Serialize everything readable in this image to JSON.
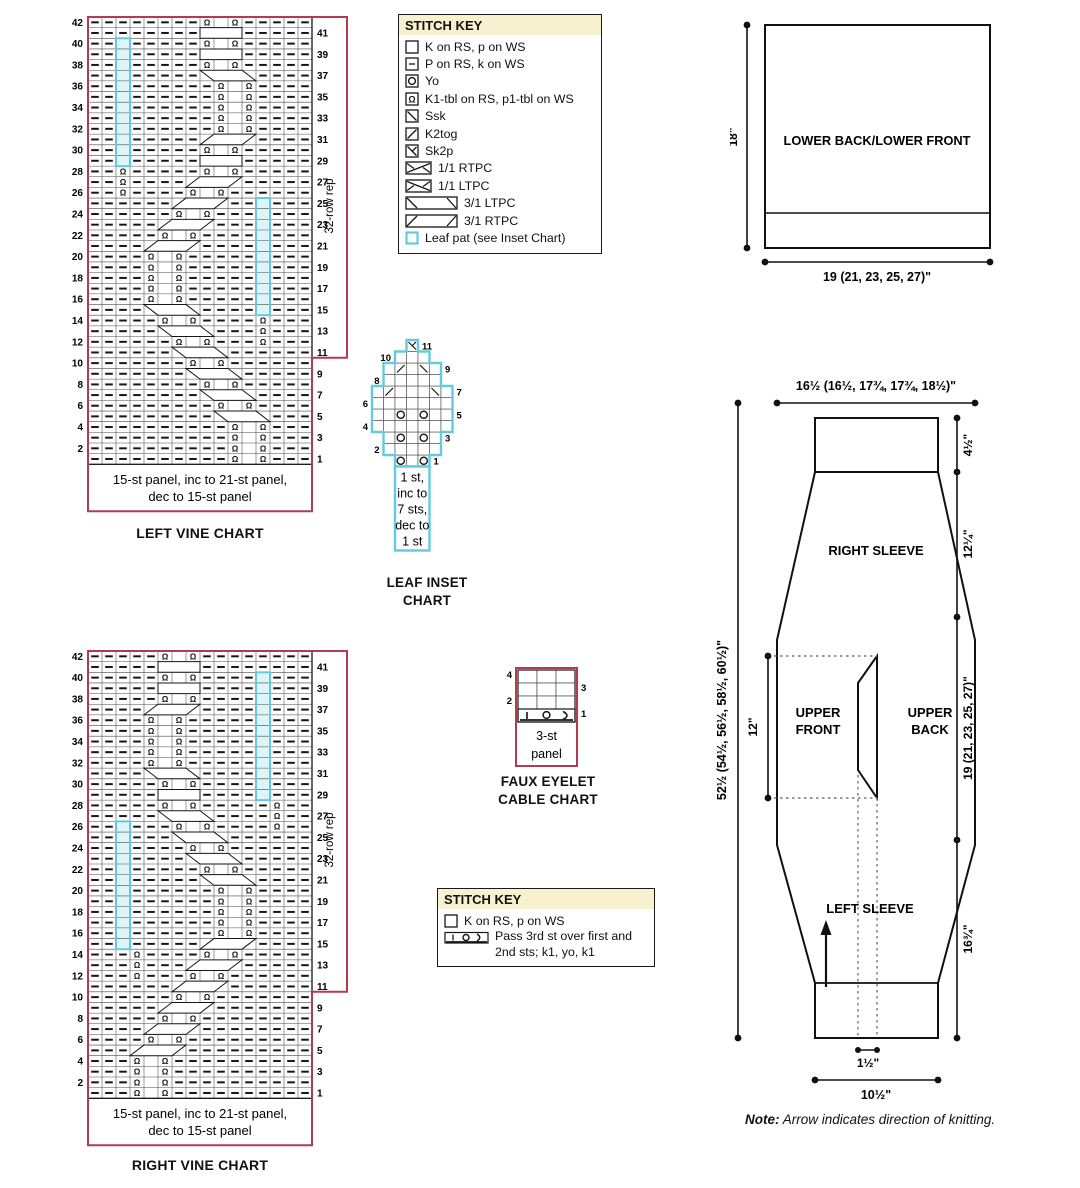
{
  "colors": {
    "red": "#b43a50",
    "cyan": "#63cbdd",
    "cyan_fill": "#def4f9",
    "cream": "#f8f1cf",
    "ink": "#111111"
  },
  "left_vine_chart": {
    "title": "LEFT VINE CHART",
    "caption_line1": "15-st panel, inc to 21-st panel,",
    "caption_line2": "dec to 15-st panel",
    "rep_label": "32-row rep",
    "rows": 42,
    "cols": 16,
    "left_numbers": [
      42,
      40,
      38,
      36,
      34,
      32,
      30,
      28,
      26,
      24,
      22,
      20,
      18,
      16,
      14,
      12,
      10,
      8,
      6,
      4,
      2
    ],
    "right_numbers": [
      41,
      39,
      37,
      35,
      33,
      31,
      29,
      27,
      25,
      23,
      21,
      19,
      17,
      15,
      13,
      11,
      9,
      7,
      5,
      3,
      1
    ]
  },
  "right_vine_chart": {
    "title": "RIGHT VINE CHART",
    "caption_line1": "15-st panel, inc to 21-st panel,",
    "caption_line2": "dec to 15-st panel",
    "rep_label": "32-row rep",
    "rows": 42,
    "cols": 16,
    "left_numbers": [
      42,
      40,
      38,
      36,
      34,
      32,
      30,
      28,
      26,
      24,
      22,
      20,
      18,
      16,
      14,
      12,
      10,
      8,
      6,
      4,
      2
    ],
    "right_numbers": [
      41,
      39,
      37,
      35,
      33,
      31,
      29,
      27,
      25,
      23,
      21,
      19,
      17,
      15,
      13,
      11,
      9,
      7,
      5,
      3,
      1
    ]
  },
  "stitch_key_1": {
    "title": "STITCH KEY",
    "entries": [
      {
        "symbol": "k",
        "label": "K on RS, p on WS"
      },
      {
        "symbol": "p",
        "label": "P on RS, k on WS"
      },
      {
        "symbol": "yo",
        "label": "Yo"
      },
      {
        "symbol": "k1tbl",
        "label": "K1-tbl on RS, p1-tbl on WS"
      },
      {
        "symbol": "ssk",
        "label": "Ssk"
      },
      {
        "symbol": "k2tog",
        "label": "K2tog"
      },
      {
        "symbol": "sk2p",
        "label": "Sk2p"
      },
      {
        "symbol": "rtpc11",
        "label": "1/1 RTPC"
      },
      {
        "symbol": "ltpc11",
        "label": "1/1 LTPC"
      },
      {
        "symbol": "ltpc31",
        "label": "3/1 LTPC"
      },
      {
        "symbol": "rtpc31",
        "label": "3/1 RTPC"
      },
      {
        "symbol": "leaf",
        "label": "Leaf pat (see Inset Chart)"
      }
    ]
  },
  "stitch_key_2": {
    "title": "STITCH KEY",
    "entries": [
      {
        "symbol": "k",
        "label": "K on RS, p on WS"
      },
      {
        "symbol": "pass3",
        "label": "Pass 3rd st over first and 2nd sts; k1, yo, k1"
      }
    ]
  },
  "leaf_inset_chart": {
    "title_line1": "LEAF INSET",
    "title_line2": "CHART",
    "caption_lines": [
      "1 st,",
      "inc to",
      "7 sts,",
      "dec to",
      "1 st"
    ],
    "left_numbers": [
      10,
      8,
      6,
      4,
      2
    ],
    "right_numbers": [
      11,
      9,
      7,
      5,
      3,
      1
    ]
  },
  "faux_eyelet_chart": {
    "title_line1": "FAUX EYELET",
    "title_line2": "CABLE CHART",
    "caption_line1": "3-st",
    "caption_line2": "panel",
    "left_numbers": [
      4,
      2
    ],
    "right_numbers": [
      3,
      1
    ]
  },
  "lower_schematic": {
    "label": "LOWER BACK/LOWER FRONT",
    "height_dim": "18\"",
    "width_dim": "19 (21, 23, 25, 27)\""
  },
  "main_schematic": {
    "top_width_dim": "16½ (16½, 17¾, 17¾, 18½)\"",
    "left_total_dim": "52½ (54½, 56½, 58½, 60½)\"",
    "front_depth_dim": "12\"",
    "right_dim_cuff": "4½\"",
    "right_dim_cap": "12¼\"",
    "right_dim_body": "19 (21, 23, 25, 27)\"",
    "right_dim_sleeve": "16¾\"",
    "cuff_gap_dim": "1½\"",
    "cuff_width_dim": "10½\"",
    "labels": {
      "right_sleeve": "RIGHT SLEEVE",
      "upper_front_1": "UPPER",
      "upper_front_2": "FRONT",
      "upper_back_1": "UPPER",
      "upper_back_2": "BACK",
      "left_sleeve": "LEFT SLEEVE"
    }
  },
  "note": {
    "prefix": "Note:",
    "text": " Arrow indicates direction of knitting."
  }
}
